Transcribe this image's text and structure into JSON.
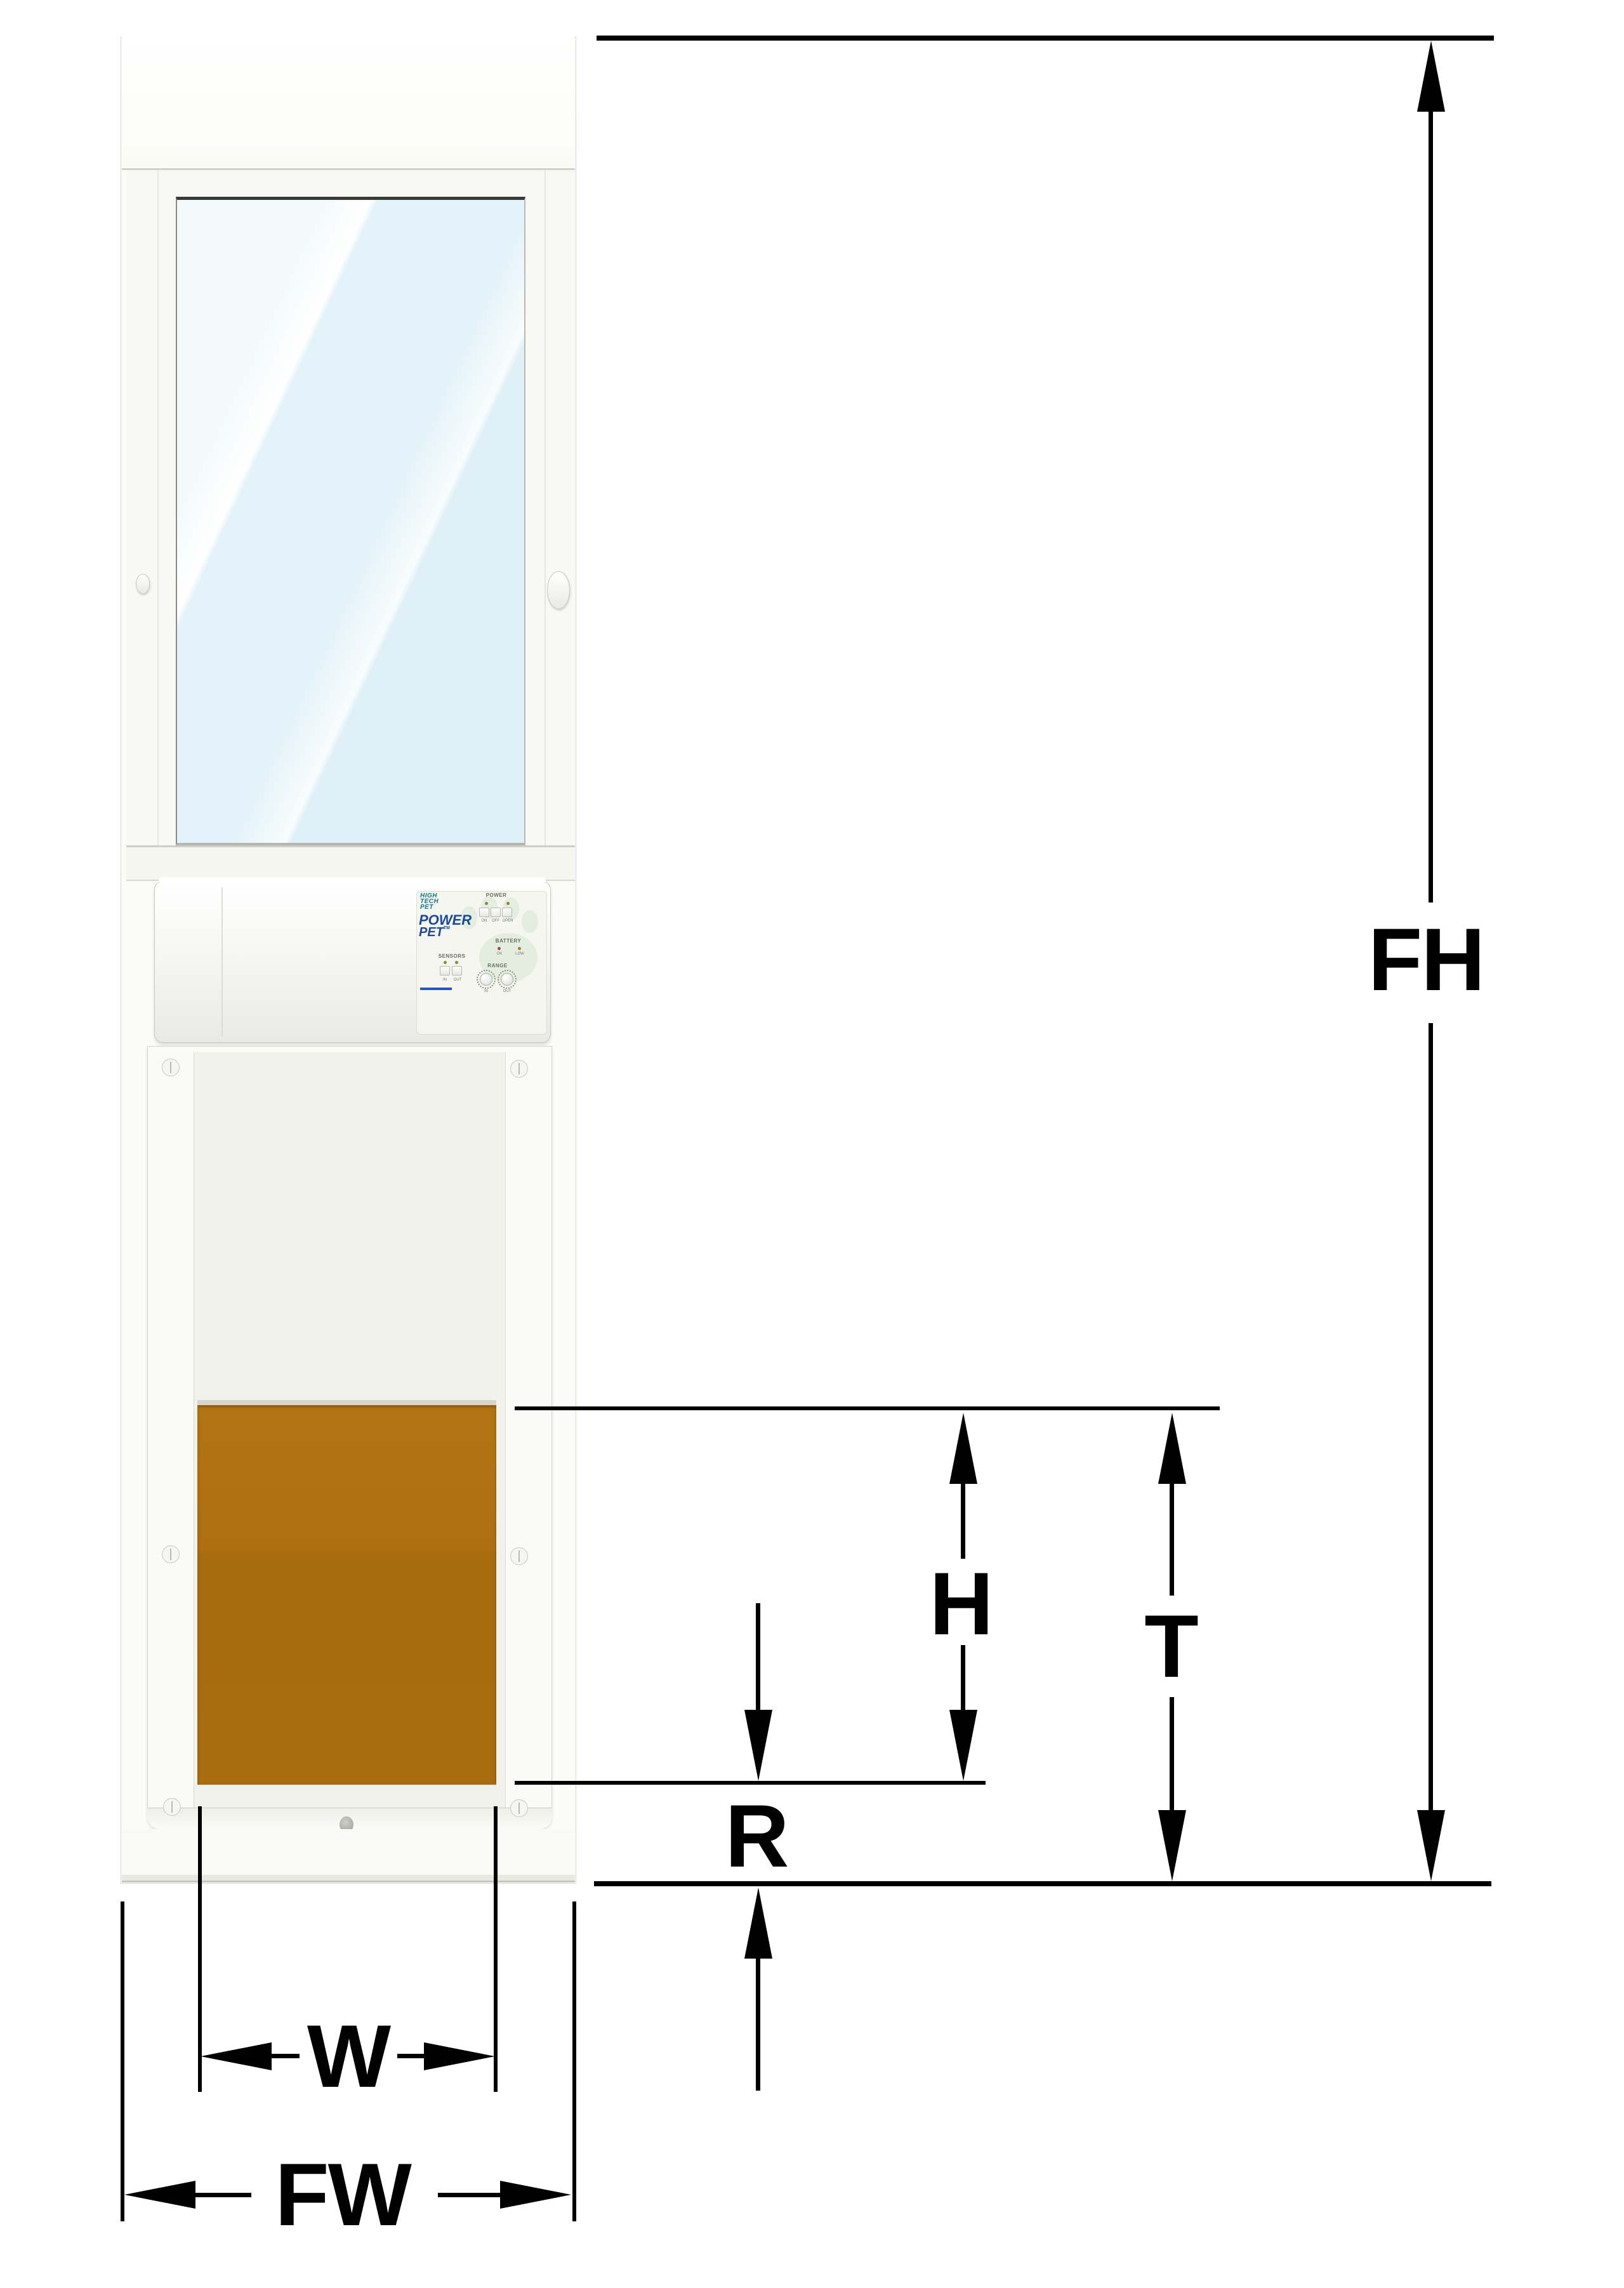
{
  "diagram": {
    "labels": {
      "frame_height": "FH",
      "flap_height": "H",
      "step_over_total": "T",
      "rise": "R",
      "flap_width": "W",
      "frame_width": "FW"
    }
  },
  "device": {
    "logo_lines": [
      "HIGH",
      "TECH",
      "PET"
    ],
    "product_line1": "POWER",
    "product_line2": "PET",
    "product_tm": "TM",
    "panel": {
      "power_label": "POWER",
      "power_buttons": [
        "ON",
        "OFF",
        "OPEN"
      ],
      "battery_label": "BATTERY",
      "battery_states": [
        "OK",
        "LOW"
      ],
      "sensors_label": "SENSORS",
      "sensor_buttons": [
        "IN",
        "OUT"
      ],
      "range_label": "RANGE",
      "range_knobs": [
        "IN",
        "OUT"
      ]
    }
  },
  "colors": {
    "flap_brown": "#aa6e10",
    "brand_blue": "#1a4a9e",
    "logo_teal": "#0d7a8a",
    "dimension_black": "#000000"
  }
}
